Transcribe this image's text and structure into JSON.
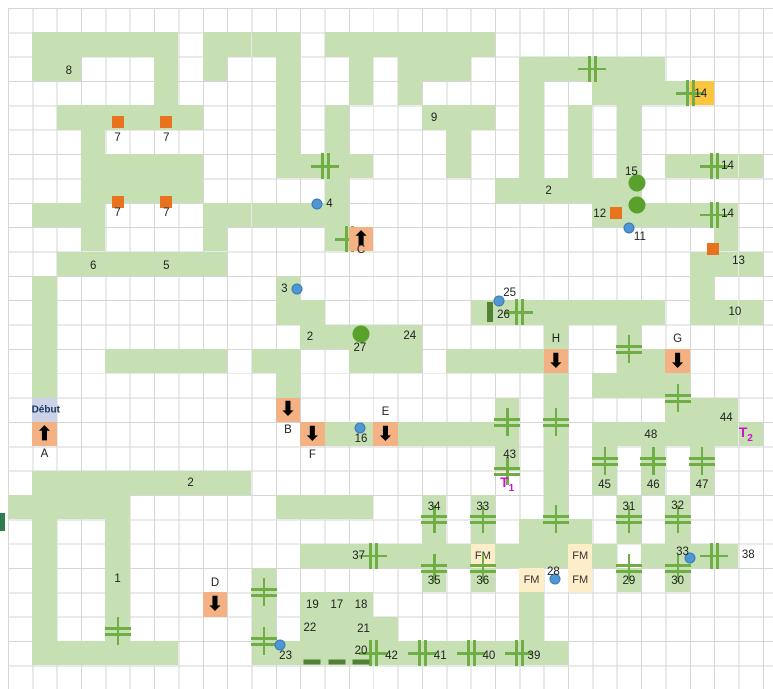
{
  "map_title": "dungeon-level-map",
  "start_label": "Début",
  "fm_label": "FM",
  "colors": {
    "corridor": "#c6e0b4",
    "door": "#6fae44",
    "dark_green": "#538135",
    "orange_marker": "#e8731e",
    "stair_cell": "#f4b183",
    "yellow_cell": "#fbc540",
    "fm_cell": "#fdeec9",
    "start_cell": "#ccd3e8",
    "dot": "#4f97d4",
    "teleport_text": "#d10fd1",
    "gridline": "#d6d6d6"
  },
  "grid": {
    "ox": 8,
    "oy": 8,
    "cw": 24.35,
    "ch": 24.35,
    "cols": 31,
    "rows": 28,
    "cells": [
      "...............................",
      ".GGGGGG.GGGG.GGGGGGG...........",
      ".GG...G.G..G..G.GGG..GGGGGG....",
      "......G....G..G.G....G..GGGGY..",
      "..GGGGGG...G.G...GGG.G.G.G.....",
      "...G.......G.G....G..G.G.G.....",
      "...GGGGG...GGGG...G..G.G.G.GGGG",
      "...GGGGG.....G......GGGGGG.....",
      ".GGG....GGGGGG..........GGGGGG.",
      "...G....G....GO..............G.",
      "..GGGGGGG...................GGG",
      ".G.........G................G..",
      ".G.........GG......GGGGGGGG.GGG",
      ".G..........GGGGG.....G..G.....",
      ".G..GGGGG.GG..GGG.GGGGO..GGO...",
      ".G.........G..........G.GGGG...",
      ".S.........O........G.G....GGG.",
      ".O..........OGGOGGGGG.G.GGGGGGG",
      "....................G.G.G.G.G..",
      ".GGGGGGGGG............G.G.G.G..",
      "GGGGG......GGGG..G.G..G..G.G...",
      ".G..G............G.G.GGG.G.G...",
      ".G..G.......GGGGGGGFGGGFG.GGGG",
      ".G..G.....G......G.G.F.F.G.G...",
      ".G..G...O.G.GGG......G.........",
      ".G..G.....G.GGGG.....G.........",
      ".GGGGGG...GGGGGGGGGGGGG........",
      "..............................."
    ]
  },
  "arrows": [
    {
      "id": "A",
      "c": 1,
      "r": 17,
      "dir": "up"
    },
    {
      "id": "B",
      "c": 11,
      "r": 16,
      "dir": "down"
    },
    {
      "id": "C",
      "c": 14,
      "r": 9,
      "dir": "up"
    },
    {
      "id": "D",
      "c": 8,
      "r": 24,
      "dir": "down"
    },
    {
      "id": "E",
      "c": 15,
      "r": 17,
      "dir": "down"
    },
    {
      "id": "F",
      "c": 12,
      "r": 17,
      "dir": "down"
    },
    {
      "id": "G",
      "c": 27,
      "r": 14,
      "dir": "down"
    },
    {
      "id": "H",
      "c": 22,
      "r": 14,
      "dir": "down"
    }
  ],
  "labels": [
    {
      "t": "8",
      "x": 2.5,
      "y": 2.6
    },
    {
      "t": "9",
      "x": 17.5,
      "y": 4.5
    },
    {
      "t": "7",
      "x": 4.5,
      "y": 5.35
    },
    {
      "t": "7",
      "x": 6.5,
      "y": 5.35
    },
    {
      "t": "7",
      "x": 4.5,
      "y": 8.4
    },
    {
      "t": "7",
      "x": 6.5,
      "y": 8.4
    },
    {
      "t": "6",
      "x": 3.5,
      "y": 10.6
    },
    {
      "t": "5",
      "x": 6.5,
      "y": 10.6
    },
    {
      "t": "4",
      "x": 13.2,
      "y": 8.05
    },
    {
      "t": "3",
      "x": 11.35,
      "y": 11.55
    },
    {
      "t": "2",
      "x": 22.2,
      "y": 7.5
    },
    {
      "t": "15",
      "x": 25.6,
      "y": 6.75
    },
    {
      "t": "12",
      "x": 24.3,
      "y": 8.45
    },
    {
      "t": "11",
      "x": 25.95,
      "y": 9.4
    },
    {
      "t": "14",
      "x": 28.45,
      "y": 3.55
    },
    {
      "t": "14",
      "x": 29.55,
      "y": 6.5
    },
    {
      "t": "14",
      "x": 29.55,
      "y": 8.45
    },
    {
      "t": "13",
      "x": 30.0,
      "y": 10.4
    },
    {
      "t": "10",
      "x": 29.85,
      "y": 12.5
    },
    {
      "t": "25",
      "x": 20.6,
      "y": 11.7
    },
    {
      "t": "26",
      "x": 20.35,
      "y": 12.6
    },
    {
      "t": "2",
      "x": 12.4,
      "y": 13.5
    },
    {
      "t": "24",
      "x": 16.5,
      "y": 13.45
    },
    {
      "t": "27",
      "x": 14.45,
      "y": 13.98
    },
    {
      "t": "C",
      "x": 14.5,
      "y": 9.95
    },
    {
      "t": "H",
      "x": 22.5,
      "y": 13.6
    },
    {
      "t": "G",
      "x": 27.5,
      "y": 13.6
    },
    {
      "t": "Début",
      "x": 1.55,
      "y": 16.5,
      "cls": "start"
    },
    {
      "t": "A",
      "x": 1.5,
      "y": 18.3
    },
    {
      "t": "B",
      "x": 11.5,
      "y": 17.35
    },
    {
      "t": "F",
      "x": 12.5,
      "y": 18.35
    },
    {
      "t": "E",
      "x": 15.5,
      "y": 16.6
    },
    {
      "t": "16",
      "x": 14.5,
      "y": 17.72
    },
    {
      "t": "2",
      "x": 7.5,
      "y": 19.5
    },
    {
      "t": "1",
      "x": 4.5,
      "y": 23.45
    },
    {
      "t": "D",
      "x": 8.5,
      "y": 23.6
    },
    {
      "t": "43",
      "x": 20.6,
      "y": 18.35
    },
    {
      "t": "44",
      "x": 29.5,
      "y": 16.85
    },
    {
      "t": "48",
      "x": 26.4,
      "y": 17.55
    },
    {
      "t": "45",
      "x": 24.5,
      "y": 19.6
    },
    {
      "t": "46",
      "x": 26.5,
      "y": 19.6
    },
    {
      "t": "47",
      "x": 28.5,
      "y": 19.6
    },
    {
      "t": "34",
      "x": 17.5,
      "y": 20.5
    },
    {
      "t": "33",
      "x": 19.5,
      "y": 20.5
    },
    {
      "t": "31",
      "x": 25.5,
      "y": 20.5
    },
    {
      "t": "32",
      "x": 27.5,
      "y": 20.45
    },
    {
      "t": "37",
      "x": 14.4,
      "y": 22.5
    },
    {
      "t": "35",
      "x": 17.5,
      "y": 23.55
    },
    {
      "t": "36",
      "x": 19.5,
      "y": 23.55
    },
    {
      "t": "29",
      "x": 25.5,
      "y": 23.55
    },
    {
      "t": "30",
      "x": 27.5,
      "y": 23.55
    },
    {
      "t": "38",
      "x": 30.4,
      "y": 22.45
    },
    {
      "t": "33",
      "x": 27.7,
      "y": 22.35
    },
    {
      "t": "28",
      "x": 22.4,
      "y": 23.18
    },
    {
      "t": "19",
      "x": 12.5,
      "y": 24.5
    },
    {
      "t": "17",
      "x": 13.5,
      "y": 24.5
    },
    {
      "t": "18",
      "x": 14.5,
      "y": 24.5
    },
    {
      "t": "22",
      "x": 12.4,
      "y": 25.45
    },
    {
      "t": "21",
      "x": 14.6,
      "y": 25.5
    },
    {
      "t": "23",
      "x": 11.4,
      "y": 26.6
    },
    {
      "t": "20",
      "x": 14.5,
      "y": 26.42
    },
    {
      "t": "42",
      "x": 15.75,
      "y": 26.6
    },
    {
      "t": "41",
      "x": 17.75,
      "y": 26.6
    },
    {
      "t": "40",
      "x": 19.75,
      "y": 26.6
    },
    {
      "t": "39",
      "x": 21.6,
      "y": 26.62
    }
  ],
  "teleports": [
    {
      "t": "T",
      "sub": "1",
      "x": 20.5,
      "y": 19.55
    },
    {
      "t": "T",
      "sub": "2",
      "x": 30.3,
      "y": 17.5
    }
  ],
  "dots": [
    {
      "x": 12.7,
      "y": 8.05
    },
    {
      "x": 11.85,
      "y": 11.55
    },
    {
      "x": 20.15,
      "y": 12.05
    },
    {
      "x": 25.5,
      "y": 9.05
    },
    {
      "x": 14.45,
      "y": 17.25
    },
    {
      "x": 22.45,
      "y": 23.45
    },
    {
      "x": 28.0,
      "y": 22.6
    },
    {
      "x": 11.15,
      "y": 26.15
    }
  ],
  "green_circles": [
    {
      "x": 25.85,
      "y": 7.2
    },
    {
      "x": 25.85,
      "y": 8.1
    },
    {
      "x": 14.5,
      "y": 13.4
    }
  ],
  "orange_squares": [
    {
      "x": 4.5,
      "y": 4.68
    },
    {
      "x": 6.5,
      "y": 4.68
    },
    {
      "x": 4.5,
      "y": 7.95
    },
    {
      "x": 6.5,
      "y": 7.95
    },
    {
      "x": 24.95,
      "y": 8.4
    },
    {
      "x": 28.95,
      "y": 9.9
    }
  ],
  "doors": [
    {
      "x": 13.0,
      "y": 6.5,
      "o": "v"
    },
    {
      "x": 24.0,
      "y": 2.5,
      "o": "v"
    },
    {
      "x": 28.0,
      "y": 3.5,
      "o": "v"
    },
    {
      "x": 29.0,
      "y": 6.5,
      "o": "v"
    },
    {
      "x": 29.0,
      "y": 8.5,
      "o": "v"
    },
    {
      "x": 21.0,
      "y": 12.5,
      "o": "v"
    },
    {
      "x": 14.0,
      "y": 9.5,
      "o": "v"
    },
    {
      "x": 29.0,
      "y": 22.5,
      "o": "v"
    },
    {
      "x": 15.0,
      "y": 22.5,
      "o": "v"
    },
    {
      "x": 15.0,
      "y": 26.5,
      "o": "v"
    },
    {
      "x": 17.0,
      "y": 26.5,
      "o": "v"
    },
    {
      "x": 19.0,
      "y": 26.5,
      "o": "v"
    },
    {
      "x": 21.0,
      "y": 26.5,
      "o": "v"
    },
    {
      "x": 25.5,
      "y": 14.0,
      "o": "h"
    },
    {
      "x": 20.5,
      "y": 17.0,
      "o": "h"
    },
    {
      "x": 22.5,
      "y": 17.0,
      "o": "h"
    },
    {
      "x": 27.5,
      "y": 16.0,
      "o": "h"
    },
    {
      "x": 20.5,
      "y": 19.0,
      "o": "h"
    },
    {
      "x": 22.5,
      "y": 21.0,
      "o": "h"
    },
    {
      "x": 24.5,
      "y": 18.6,
      "o": "h"
    },
    {
      "x": 26.5,
      "y": 18.6,
      "o": "h"
    },
    {
      "x": 28.5,
      "y": 18.6,
      "o": "h"
    },
    {
      "x": 17.5,
      "y": 21.0,
      "o": "h"
    },
    {
      "x": 19.5,
      "y": 21.0,
      "o": "h"
    },
    {
      "x": 17.5,
      "y": 23.0,
      "o": "h"
    },
    {
      "x": 19.5,
      "y": 23.0,
      "o": "h"
    },
    {
      "x": 25.5,
      "y": 21.0,
      "o": "h"
    },
    {
      "x": 27.5,
      "y": 21.0,
      "o": "h"
    },
    {
      "x": 25.5,
      "y": 23.0,
      "o": "h"
    },
    {
      "x": 27.5,
      "y": 23.0,
      "o": "h"
    },
    {
      "x": 10.5,
      "y": 24.0,
      "o": "h"
    },
    {
      "x": 10.5,
      "y": 26.0,
      "o": "h"
    },
    {
      "x": 4.5,
      "y": 25.6,
      "o": "h"
    }
  ],
  "dark_bars": [
    {
      "x": 19.78,
      "y": 12.5,
      "w": 6,
      "h": 20
    },
    {
      "x": 12.5,
      "y": 26.85,
      "w": 17,
      "h": 5
    },
    {
      "x": 13.5,
      "y": 26.85,
      "w": 17,
      "h": 5
    },
    {
      "x": 14.5,
      "y": 26.85,
      "w": 17,
      "h": 5
    }
  ],
  "edge_bar": {
    "x": 0,
    "y": 513,
    "w": 5,
    "h": 18
  }
}
